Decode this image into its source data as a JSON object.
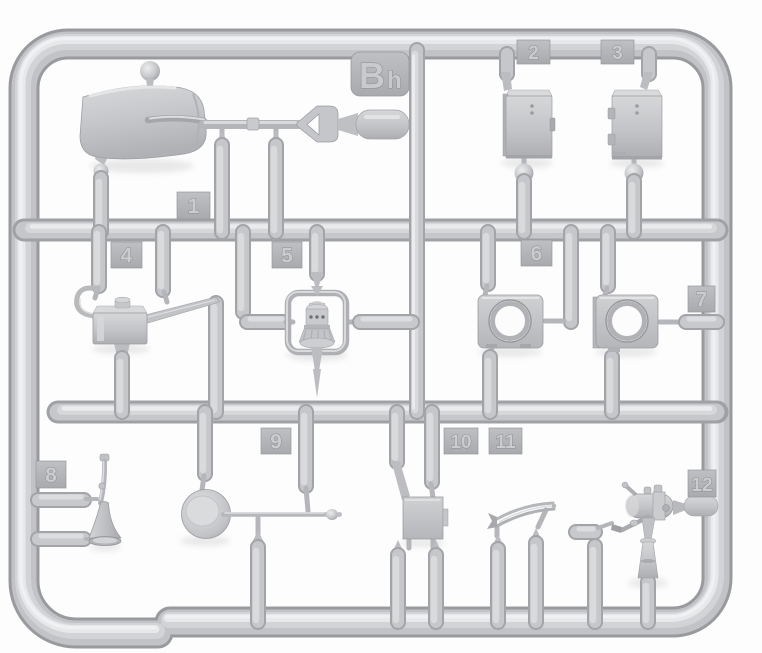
{
  "sprue": {
    "label": {
      "full": "Bh",
      "main": "B",
      "sub": "h"
    },
    "part_tags": [
      "1",
      "2",
      "3",
      "4",
      "5",
      "6",
      "7",
      "8",
      "9",
      "10",
      "11",
      "12"
    ],
    "parts": [
      {
        "tag": "1",
        "name": "shovel"
      },
      {
        "tag": "2",
        "name": "storage-box-with-latch"
      },
      {
        "tag": "3",
        "name": "storage-box-with-hinges"
      },
      {
        "tag": "4",
        "name": "oil-can"
      },
      {
        "tag": "5",
        "name": "lantern-in-carry-frame"
      },
      {
        "tag": "6",
        "name": "ring-plate"
      },
      {
        "tag": "7",
        "name": "ring-plate-flanged"
      },
      {
        "tag": "8",
        "name": "bugle"
      },
      {
        "tag": "9",
        "name": "frying-pan"
      },
      {
        "tag": "10",
        "name": "flat-plate"
      },
      {
        "tag": "11",
        "name": "curved-blade"
      },
      {
        "tag": "12",
        "name": "blowtorch"
      }
    ],
    "part_count": "12",
    "colors": {
      "background": "#fdfdfd",
      "plastic_mid": "#c7c8cb",
      "plastic_highlight": "#e8e9eb",
      "plastic_shadow": "#9b9ca0",
      "tag_face": "#b4b5b9",
      "emboss_text": "#c9cacd"
    }
  }
}
